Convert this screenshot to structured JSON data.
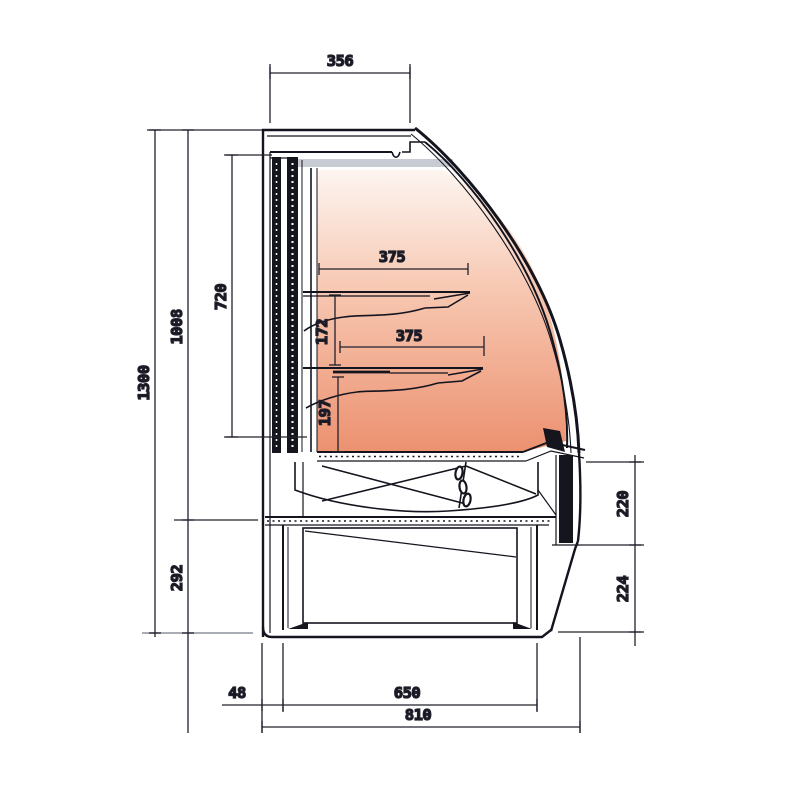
{
  "diagram": {
    "type": "technical-drawing",
    "subject": "serve-over refrigerated display counter, side cross-section with dimensions",
    "units": "mm",
    "dimensions": {
      "top_depth": "356",
      "overall_height": "1300",
      "body_height": "1008",
      "display_opening_height": "720",
      "upper_shelf_depth": "375",
      "upper_shelf_spacing": "172",
      "lower_shelf_depth": "375",
      "lower_shelf_spacing": "197",
      "plinth_height": "292",
      "front_panel_height": "220",
      "base_front_height": "224",
      "rear_overhang": "48",
      "base_depth": "650",
      "overall_depth": "810"
    },
    "colors": {
      "line": "#15151e",
      "dimension_line": "#20202c",
      "interior_glow_top": "#fdf5f0",
      "interior_glow_bottom": "#ec9170",
      "trim_gray": "#c7cbd2"
    }
  }
}
